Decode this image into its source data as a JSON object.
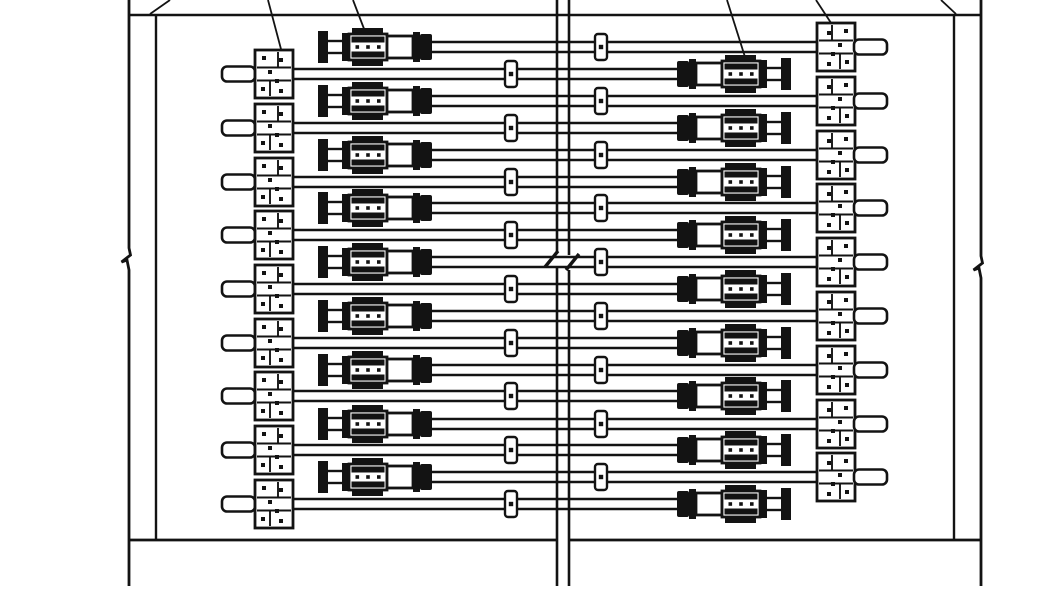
{
  "drawing": {
    "background": "#ffffff",
    "ink": "#131313",
    "canvas": {
      "w": 1064,
      "h": 600
    },
    "edges": [
      {
        "name": "top-edge-line",
        "x1": 128,
        "y1": 15,
        "x2": 980,
        "y2": 15,
        "w": 2.6
      },
      {
        "name": "bottom-edge-line-left",
        "x1": 128,
        "y1": 540,
        "x2": 557,
        "y2": 540,
        "w": 2.8
      },
      {
        "name": "bottom-edge-line-right",
        "x1": 569,
        "y1": 540,
        "x2": 980,
        "y2": 540,
        "w": 2.8
      }
    ],
    "verticals": [
      {
        "name": "left-outer-line",
        "x": 129,
        "y1": 0,
        "y2": 586,
        "brk": 259,
        "w": 2.8
      },
      {
        "name": "left-inner-line",
        "x": 156,
        "y1": 15,
        "y2": 540,
        "brk": null,
        "w": 2.4
      },
      {
        "name": "joint-left-line",
        "x": 557,
        "y1": 0,
        "y2": 586,
        "gap": [
          252,
          267
        ],
        "w": 2.6
      },
      {
        "name": "joint-right-line",
        "x": 569,
        "y1": 0,
        "y2": 586,
        "gap": [
          255,
          270
        ],
        "w": 2.6
      },
      {
        "name": "right-inner-line",
        "x": 954,
        "y1": 15,
        "y2": 540,
        "brk": null,
        "w": 2.4
      },
      {
        "name": "right-outer-line",
        "x": 981,
        "y1": 0,
        "y2": 586,
        "brk": 267,
        "w": 2.8
      }
    ],
    "joint_break_ticks": [
      {
        "name": "joint-break-tick-left",
        "x1": 558,
        "y1": 251,
        "x2": 545,
        "y2": 267,
        "w": 3.4
      },
      {
        "name": "joint-break-tick-right",
        "x1": 566,
        "y1": 270,
        "x2": 579,
        "y2": 254,
        "w": 3.4
      }
    ],
    "leaders": [
      {
        "name": "leader-line-1",
        "x1": 170,
        "y1": 0,
        "x2": 150,
        "y2": 14
      },
      {
        "name": "leader-line-2",
        "x1": 268,
        "y1": 0,
        "x2": 286,
        "y2": 68
      },
      {
        "name": "leader-line-3",
        "x1": 353,
        "y1": 0,
        "x2": 366,
        "y2": 34
      },
      {
        "name": "leader-line-4",
        "x1": 727,
        "y1": 0,
        "x2": 745,
        "y2": 57
      },
      {
        "name": "leader-line-5",
        "x1": 816,
        "y1": 0,
        "x2": 835,
        "y2": 29
      },
      {
        "name": "leader-line-6",
        "x1": 941,
        "y1": 0,
        "x2": 956,
        "y2": 14
      }
    ],
    "rows": [
      {
        "type": "A",
        "y": 47
      },
      {
        "type": "B",
        "y": 74
      },
      {
        "type": "A",
        "y": 101
      },
      {
        "type": "B",
        "y": 128
      },
      {
        "type": "A",
        "y": 155
      },
      {
        "type": "B",
        "y": 182
      },
      {
        "type": "A",
        "y": 208
      },
      {
        "type": "B",
        "y": 235
      },
      {
        "type": "A",
        "y": 262
      },
      {
        "type": "B",
        "y": 289
      },
      {
        "type": "A",
        "y": 316
      },
      {
        "type": "B",
        "y": 343
      },
      {
        "type": "A",
        "y": 370
      },
      {
        "type": "B",
        "y": 396
      },
      {
        "type": "A",
        "y": 424
      },
      {
        "type": "B",
        "y": 450
      },
      {
        "type": "A",
        "y": 477
      },
      {
        "type": "B",
        "y": 504
      }
    ],
    "layout": {
      "A": {
        "tb_x": 318,
        "rod_x1": 428,
        "rod_x2": 820,
        "coupler_x": 601,
        "plate_x": 817,
        "stub_x1": 854
      },
      "B": {
        "stub_x1": 222,
        "plate_x": 255,
        "rod_x1": 290,
        "rod_x2": 681,
        "coupler_x": 511,
        "tb_x": 677
      }
    },
    "parts": {
      "rod_half_gap": 5,
      "rod_lw": 2.5,
      "coupler": {
        "w": 12,
        "h": 26
      },
      "plate": {
        "w": 38,
        "h": 48
      },
      "stub": {
        "w": 33,
        "h": 15
      },
      "turnbuckle": {
        "w": 114
      }
    }
  }
}
